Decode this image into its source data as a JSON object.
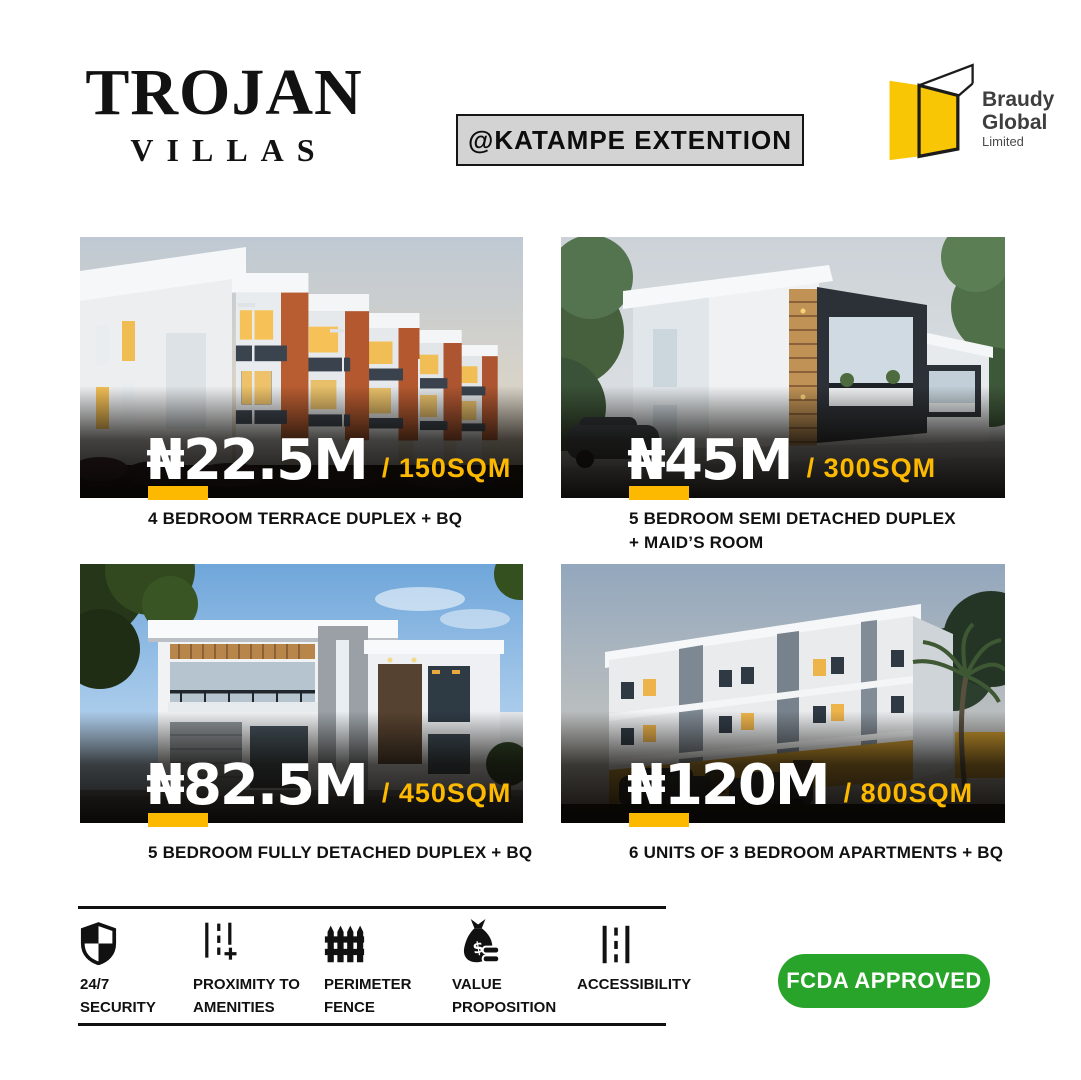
{
  "header": {
    "brand_title": "TROJAN",
    "brand_subtitle": "VILLAS",
    "location_badge": "@KATAMPE EXTENTION",
    "logo": {
      "icon": "open-door-icon",
      "line1": "Braudy",
      "line2": "Global",
      "line3": "Limited"
    }
  },
  "listings": [
    {
      "price": "₦22.5M",
      "area": "/ 150SQM",
      "caption": "4 BEDROOM TERRACE DUPLEX + BQ",
      "photo": "terrace-duplex-row-dusk-render"
    },
    {
      "price": "₦45M",
      "area": "/ 300SQM",
      "caption": "5 BEDROOM SEMI DETACHED DUPLEX\n+ MAID’S ROOM",
      "photo": "semi-detached-duplex-render"
    },
    {
      "price": "₦82.5M",
      "area": "/ 450SQM",
      "caption": "5 BEDROOM FULLY DETACHED DUPLEX + BQ",
      "photo": "fully-detached-duplex-render"
    },
    {
      "price": "₦120M",
      "area": "/ 800SQM",
      "caption": "6 UNITS OF 3 BEDROOM APARTMENTS + BQ",
      "photo": "three-storey-apartments-dusk-render"
    }
  ],
  "features": [
    {
      "icon": "shield-icon",
      "label": "24/7\nSECURITY"
    },
    {
      "icon": "proximity-road-icon",
      "label": "PROXIMITY TO\nAMENITIES"
    },
    {
      "icon": "fence-icon",
      "label": "PERIMETER\nFENCE"
    },
    {
      "icon": "money-bag-icon",
      "label": "VALUE\nPROPOSITION"
    },
    {
      "icon": "road-icon",
      "label": "ACCESSIBILITY"
    }
  ],
  "approval": {
    "label": "FCDA APPROVED"
  },
  "colors": {
    "accent_yellow": "#FCB900",
    "approval_green": "#28A42B",
    "badge_gray": "#D3D3D3",
    "logo_yellow": "#F9C606"
  }
}
